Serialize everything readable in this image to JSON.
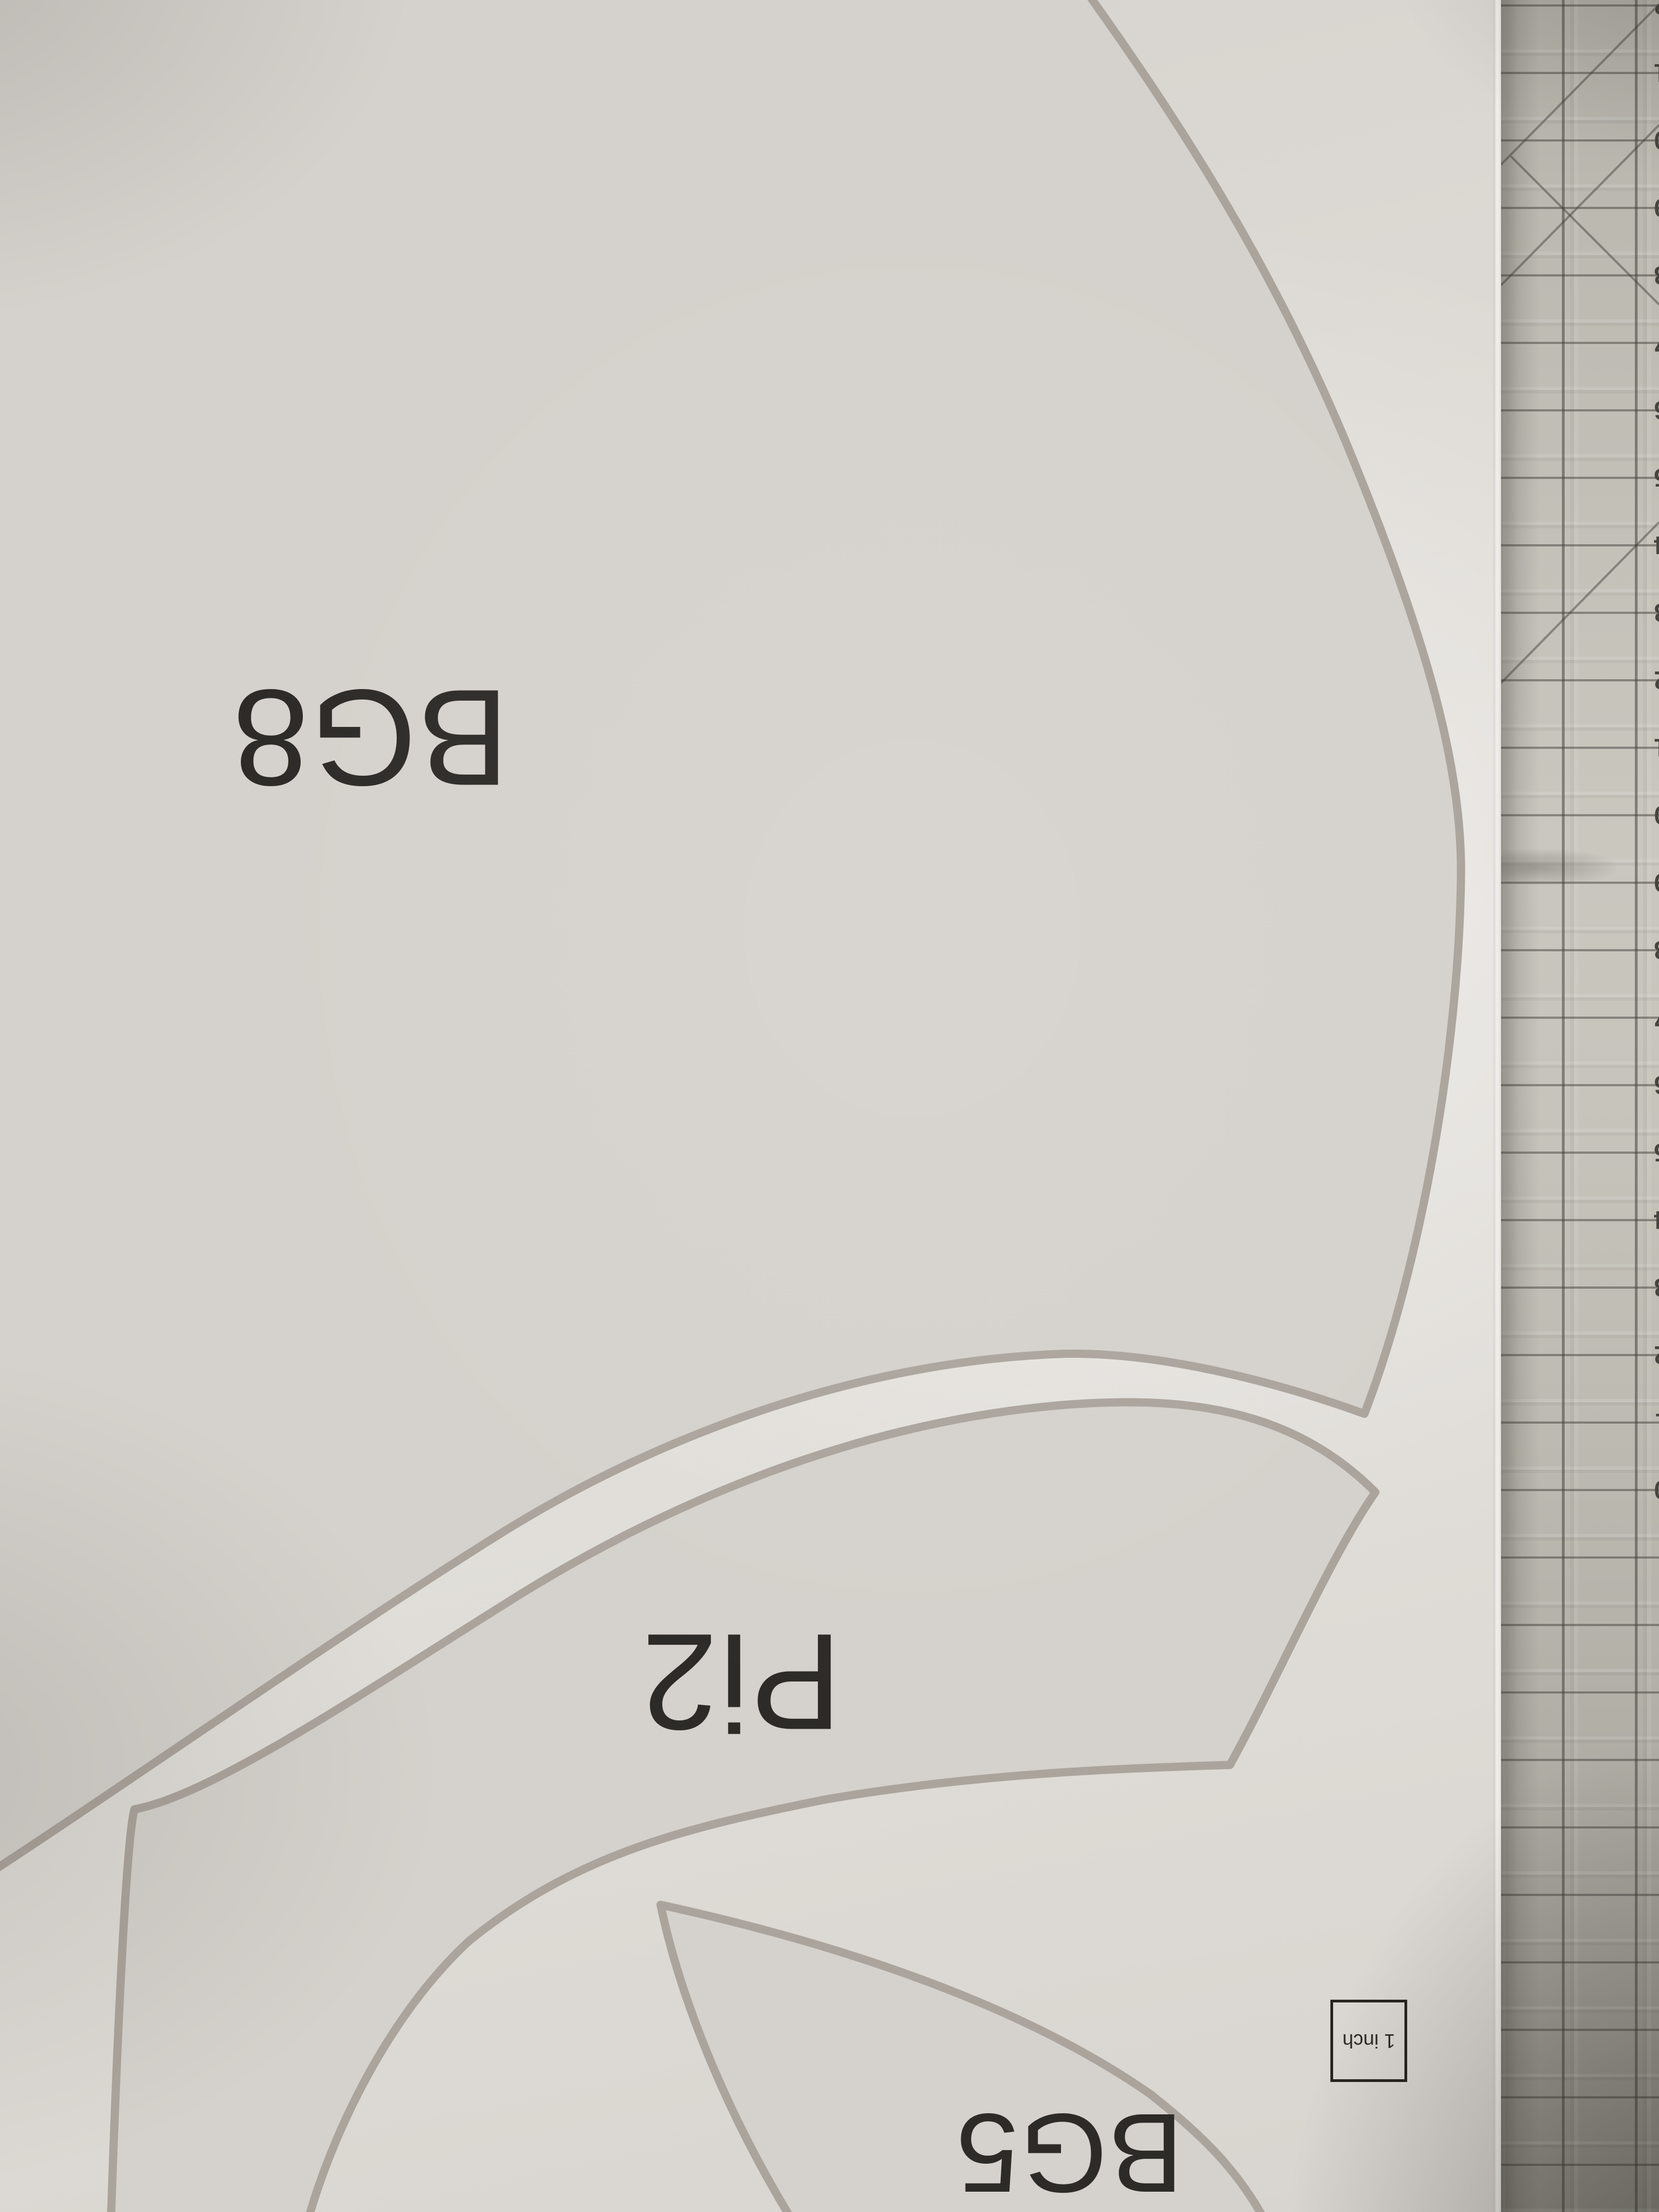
{
  "labels": {
    "bg8": "BG8",
    "pi2": "Pi2",
    "bg5": "BG5"
  },
  "scale_box": {
    "label": "1 inch"
  },
  "mat": {
    "numbers": [
      "32",
      "31",
      "30",
      "29",
      "28",
      "27",
      "26",
      "25",
      "24",
      "23",
      "22",
      "21",
      "20",
      "19",
      "18",
      "17",
      "16",
      "15",
      "14",
      "13",
      "12",
      "11",
      "10",
      "9",
      "8",
      "7",
      "6",
      "5",
      "4",
      "3",
      "2",
      "1",
      "0"
    ]
  },
  "colors": {
    "paper": "#e0ddd8",
    "piece_fill": "#d5d1cc",
    "piece_outline": "#aba49d",
    "label_ink": "#2d2b28",
    "mat_base": "#bdbbb2",
    "mat_grid_line": "#6e6c66",
    "mat_number_ink": "#45443f"
  }
}
